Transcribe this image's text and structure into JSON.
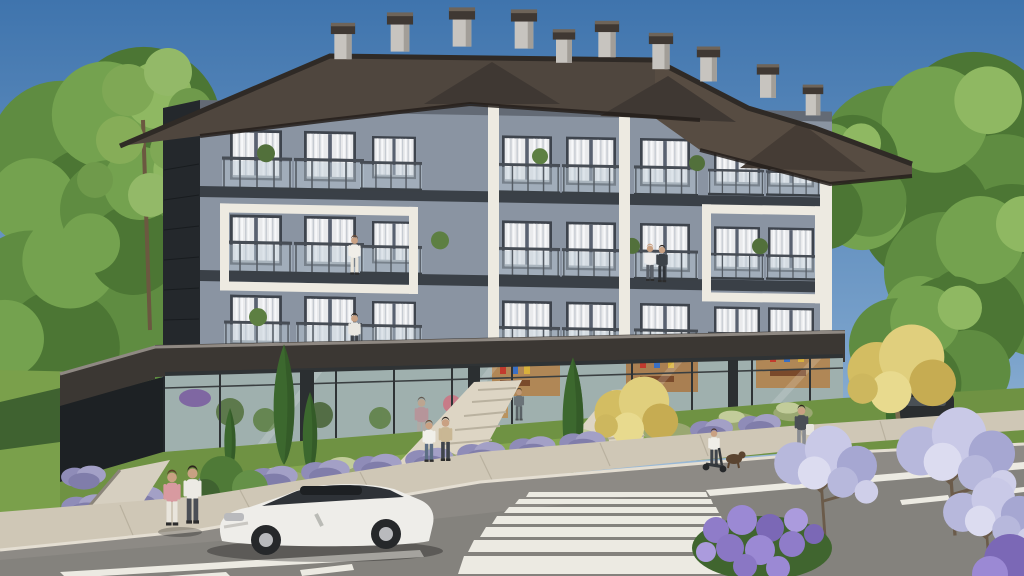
{
  "image": {
    "type": "3d architectural exterior rendering",
    "conditions": "sunny daytime, clear blue sky",
    "subject": "modern four-storey residential building with ground-floor glass shops, street frontage with parked white coupe and zebra crosswalk"
  },
  "palette": {
    "sky_top": "#3f74ad",
    "sky_mid": "#7ba3cc",
    "sky_horizon": "#b9cfdf",
    "foliage_dark": "#4c7634",
    "foliage_mid": "#5f8c41",
    "foliage_light": "#74a24f",
    "foliage_pale": "#8fb862",
    "gold_tree": "#d8c368",
    "roof": "#4f463e",
    "roof_dark": "#3f3833",
    "roof_ridge": "#2f2a26",
    "chimney_light": "#c7c4bf",
    "facade": "#8a94a2",
    "facade_shadow": "#76818f",
    "trim_white": "#edeae1",
    "slab_dark": "#3a4047",
    "side_wall": "#24282c",
    "window_frame": "#3e444d",
    "curtain": "#e9eaec",
    "fascia": "#3b3733",
    "fascia_lip": "#8f8983",
    "store_glass": "#a9b8b6",
    "interior_warm": "#b08756",
    "grass": "#6f9243",
    "grass_light": "#8fb055",
    "hedge": "#3f6230",
    "sidewalk": "#cfc7b6",
    "path": "#ddd5c4",
    "road": "#8d8a85",
    "road_dark": "#7e7b76",
    "marking_white": "#eceae2",
    "car_body": "#eeede9",
    "car_glass": "#2e3237",
    "lavender": "#8f8cb8",
    "hydrangea": "#8f7cc9",
    "lilac_tree": "#b7b8dc",
    "skin": "#c9a183"
  },
  "building": {
    "storeys_visible": 4,
    "residential_floors": 3,
    "ground_floor": "full-height glass storefronts with shop interiors",
    "roof": "dark hipped shingle roof with front gables and many grey chimneys",
    "facade": "blue-grey render with large white feature frames around balcony groups",
    "balconies": "glass-balustrade balconies, white curtains behind sliding doors, potted plants",
    "occupants": [
      "woman standing on middle-left balcony",
      "couple standing on middle-centre balcony",
      "man standing on lower-left balcony"
    ]
  },
  "street": {
    "vehicles": [
      {
        "type": "luxury coupe",
        "color": "white",
        "state": "parked along kerb facing left"
      },
      {
        "type": "SUV",
        "color": "dark grey",
        "state": "parked far right behind golden tree"
      }
    ],
    "road_markings": [
      "zebra crosswalk lower right",
      "dashed centre line",
      "solid white edge lines"
    ],
    "sidewalk": "light paved promenade with lavender planting strip and stepping-stone entry paths"
  },
  "people_outdoors": [
    "couple walking on lower-left sidewalk",
    "couple approaching the shop entrance path",
    "man with bag walking on right sidewalk",
    "child on kick scooter with small dog on right sidewalk"
  ],
  "vegetation": {
    "left": "tall pines and leafy green trees on a grassy slope with clipped hedge",
    "right": "dense green trees with golden accents",
    "front": "columnar cypresses, sage bushes, lavender rows, two golden-yellow trees",
    "foreground": "purple hydrangea bush and pale-violet flowering trees at lower right"
  }
}
